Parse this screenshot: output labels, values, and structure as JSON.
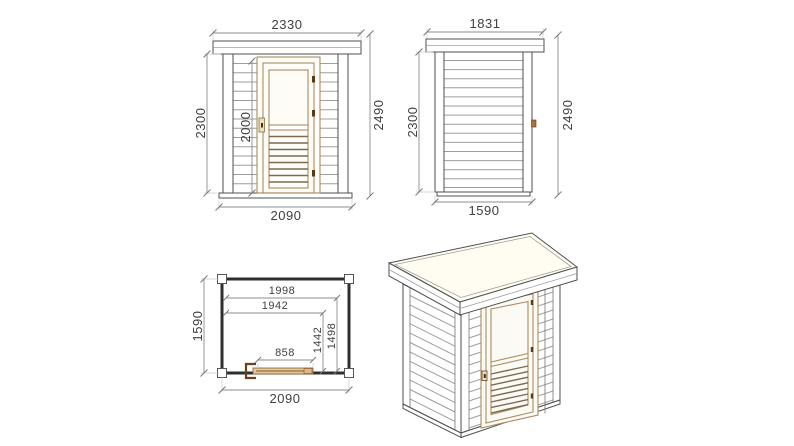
{
  "drawing": {
    "front_elevation": {
      "dims": {
        "roof_width": "2330",
        "wall_height": "2300",
        "door_height": "2000",
        "total_height": "2490",
        "wall_width": "2090"
      }
    },
    "side_elevation": {
      "dims": {
        "roof_depth": "1831",
        "wall_height": "2300",
        "total_height": "2490",
        "wall_depth": "1590"
      }
    },
    "floor_plan": {
      "dims": {
        "inner_width_full": "1998",
        "inner_width_partial": "1942",
        "inner_depth_partial": "1442",
        "inner_depth_full": "1498",
        "door_opening_width": "858",
        "outer_width": "2090",
        "outer_depth": "1590"
      }
    },
    "colors": {
      "background": "#ffffff",
      "outline": "#4f4f4f",
      "siding_line": "#9e9e9e",
      "dimension_line": "#8c8c8c",
      "dimension_text": "#3f3f3f",
      "door_frame": "#a98c60",
      "door_slat": "#7d6a52",
      "hinge": "#5f3813",
      "plan_wall": "#2e2e2e",
      "plan_door_fill": "#e3c79a",
      "roof_fill": "#fffdf2"
    }
  }
}
